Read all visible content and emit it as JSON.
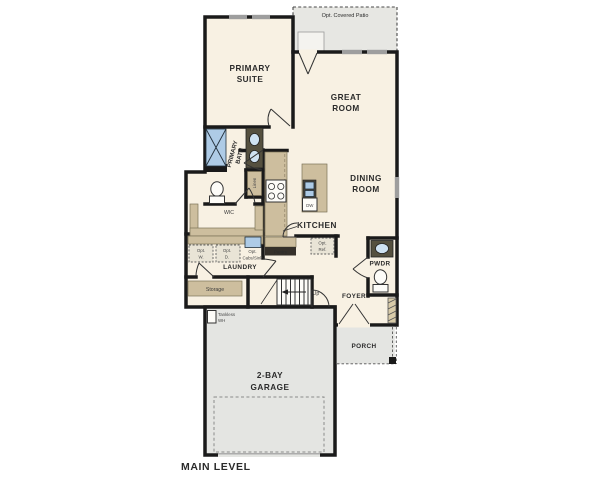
{
  "plan_title": "MAIN LEVEL",
  "colors": {
    "wall": "#1a1a1a",
    "floor": "#f8f1e3",
    "outdoor_gray": "#e5e5e1",
    "counter_tan": "#cdbe9e",
    "cabinet_dark": "#55503f",
    "fixture_blue": "#aecbe6",
    "window_gray": "#9e9e9e",
    "label_text": "#2b2b2b"
  },
  "rooms": {
    "patio": {
      "label": "Opt. Covered Patio"
    },
    "primary_suite": {
      "line1": "PRIMARY",
      "line2": "SUITE"
    },
    "great_room": {
      "line1": "GREAT",
      "line2": "ROOM"
    },
    "dining_room": {
      "line1": "DINING",
      "line2": "ROOM"
    },
    "kitchen": {
      "label": "KITCHEN"
    },
    "primary_bath": {
      "line1": "PRIMARY",
      "line2": "BATH"
    },
    "wic": {
      "label": "WIC"
    },
    "laundry": {
      "label": "LAUNDRY"
    },
    "foyer": {
      "label": "FOYER"
    },
    "powder": {
      "label": "PWDR"
    },
    "porch": {
      "label": "PORCH"
    },
    "garage": {
      "line1": "2-BAY",
      "line2": "GARAGE"
    }
  },
  "features": {
    "linen": {
      "label": "Linen"
    },
    "pantry": {
      "label": "Pantry"
    },
    "storage": {
      "label": "Storage"
    },
    "dishwasher": {
      "label": "DW"
    },
    "stairs": {
      "label": "Up"
    },
    "tankless_wh": {
      "line1": "Tankless",
      "line2": "WH"
    },
    "opt_washer": {
      "line1": "Opt.",
      "line2": "W."
    },
    "opt_dryer": {
      "line1": "Opt.",
      "line2": "D."
    },
    "opt_cabs_sink": {
      "line1": "Opt.",
      "line2": "Cabs/Sink"
    },
    "opt_ref": {
      "line1": "Opt.",
      "line2": "Ref."
    }
  }
}
